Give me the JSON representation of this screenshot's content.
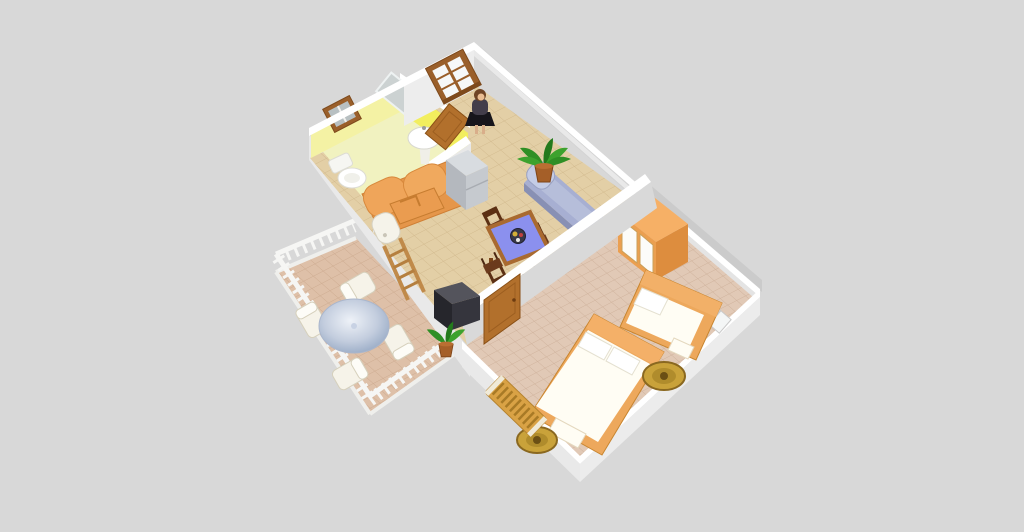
{
  "scene": {
    "type": "3d-home-floor-plan-render",
    "view": "aerial-oblique",
    "rooms_count": 4
  },
  "rooms": [
    {
      "id": "bathroom",
      "label": "Bathroom",
      "objects": [
        "mirror",
        "washbasin",
        "toilet",
        "small-window",
        "open-door"
      ]
    },
    {
      "id": "living-dining-room",
      "label": "Living / Dining Room",
      "objects": [
        "orange-sofa",
        "white-appliance",
        "refrigerator",
        "blue-chaise-longue",
        "potted-plant",
        "dining-table",
        "dining-chairs-x4",
        "plate-of-food",
        "tv-set",
        "wooden-ladder",
        "grid-window",
        "woman-figure"
      ]
    },
    {
      "id": "bedroom",
      "label": "Bedroom",
      "objects": [
        "wardrobe",
        "single-bed",
        "double-bed",
        "round-rug-x2",
        "radiator",
        "door",
        "small-window"
      ]
    },
    {
      "id": "balcony",
      "label": "Balcony",
      "objects": [
        "round-patio-table",
        "patio-chairs-x4",
        "potted-plant",
        "white-railing"
      ]
    }
  ],
  "counts": {
    "dining_chairs": 4,
    "patio_chairs": 4,
    "beds": 2,
    "rugs": 2,
    "plants": 2,
    "people": 1
  },
  "colors": {
    "background": "#d8d8d8",
    "wall_cap": "#ffffff",
    "wall_face_light": "#ececec",
    "wall_face_shadow": "#d9d9d9",
    "bathroom_wall_bright": "#f2ee5e",
    "bathroom_wall_pale": "#f4f2a4",
    "bathroom_floor": "#f1f2c0",
    "living_floor": "#e3cfa6",
    "living_floor_grid": "#d2ba8e",
    "bedroom_floor": "#e1c9b6",
    "bedroom_floor_grid": "#cfb29c",
    "balcony_floor": "#dec0a8",
    "balcony_floor_grid": "#cdab90",
    "sofa_orange": "#e5964a",
    "sofa_orange_light": "#efa55a",
    "wood_frame": "#9a5f2a",
    "door_brown": "#b2702c",
    "chaise_blue": "#a7afd2",
    "chaise_blue_dark": "#8890b4",
    "dining_table_top": "#8b90ee",
    "dining_table_edge": "#a96a30",
    "chair_wood_dark": "#5c3014",
    "mattress_white": "#fffdf4",
    "bed_frame": "#eda85c",
    "wardrobe_orange": "#eb9f50",
    "fridge_gray": "#b4b8be",
    "fridge_gray_light": "#d8dce0",
    "tv_dark": "#26262c",
    "tv_top": "#54545c",
    "rug_gold": "#c9a23a",
    "rug_gold_dark": "#8a6820",
    "plant_green": "#2f8f25",
    "plant_pot": "#a55f28",
    "railing_white": "#f6f6f4",
    "patio_chair_white": "#f6f3e9",
    "person_hair": "#6f4526",
    "person_jacket": "#433d4a",
    "person_skirt": "#17151b",
    "person_skin": "#e9bd92",
    "radiator_gold": "#d9a245"
  }
}
